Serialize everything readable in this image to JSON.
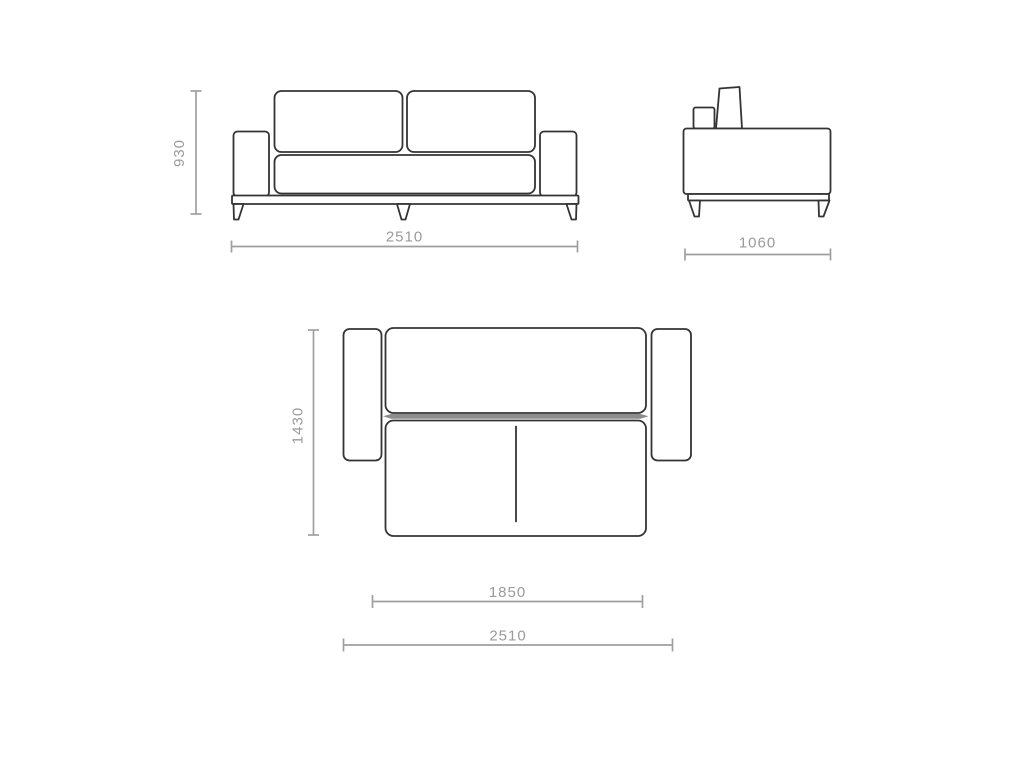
{
  "drawing": {
    "description": "sofa-bed technical dimension drawing, three orthographic views",
    "front_view": {
      "height_label": "930",
      "width_label": "2510"
    },
    "side_view": {
      "depth_label": "1060"
    },
    "top_view": {
      "depth_label": "1430",
      "mattress_width_label": "1850",
      "width_label": "2510"
    },
    "colors": {
      "outline": "#343434",
      "dimension_lines": "#9f9f9f",
      "dimension_text": "#9b9b9b",
      "divider": "#8c8c8c",
      "background": "#ffffff"
    }
  }
}
